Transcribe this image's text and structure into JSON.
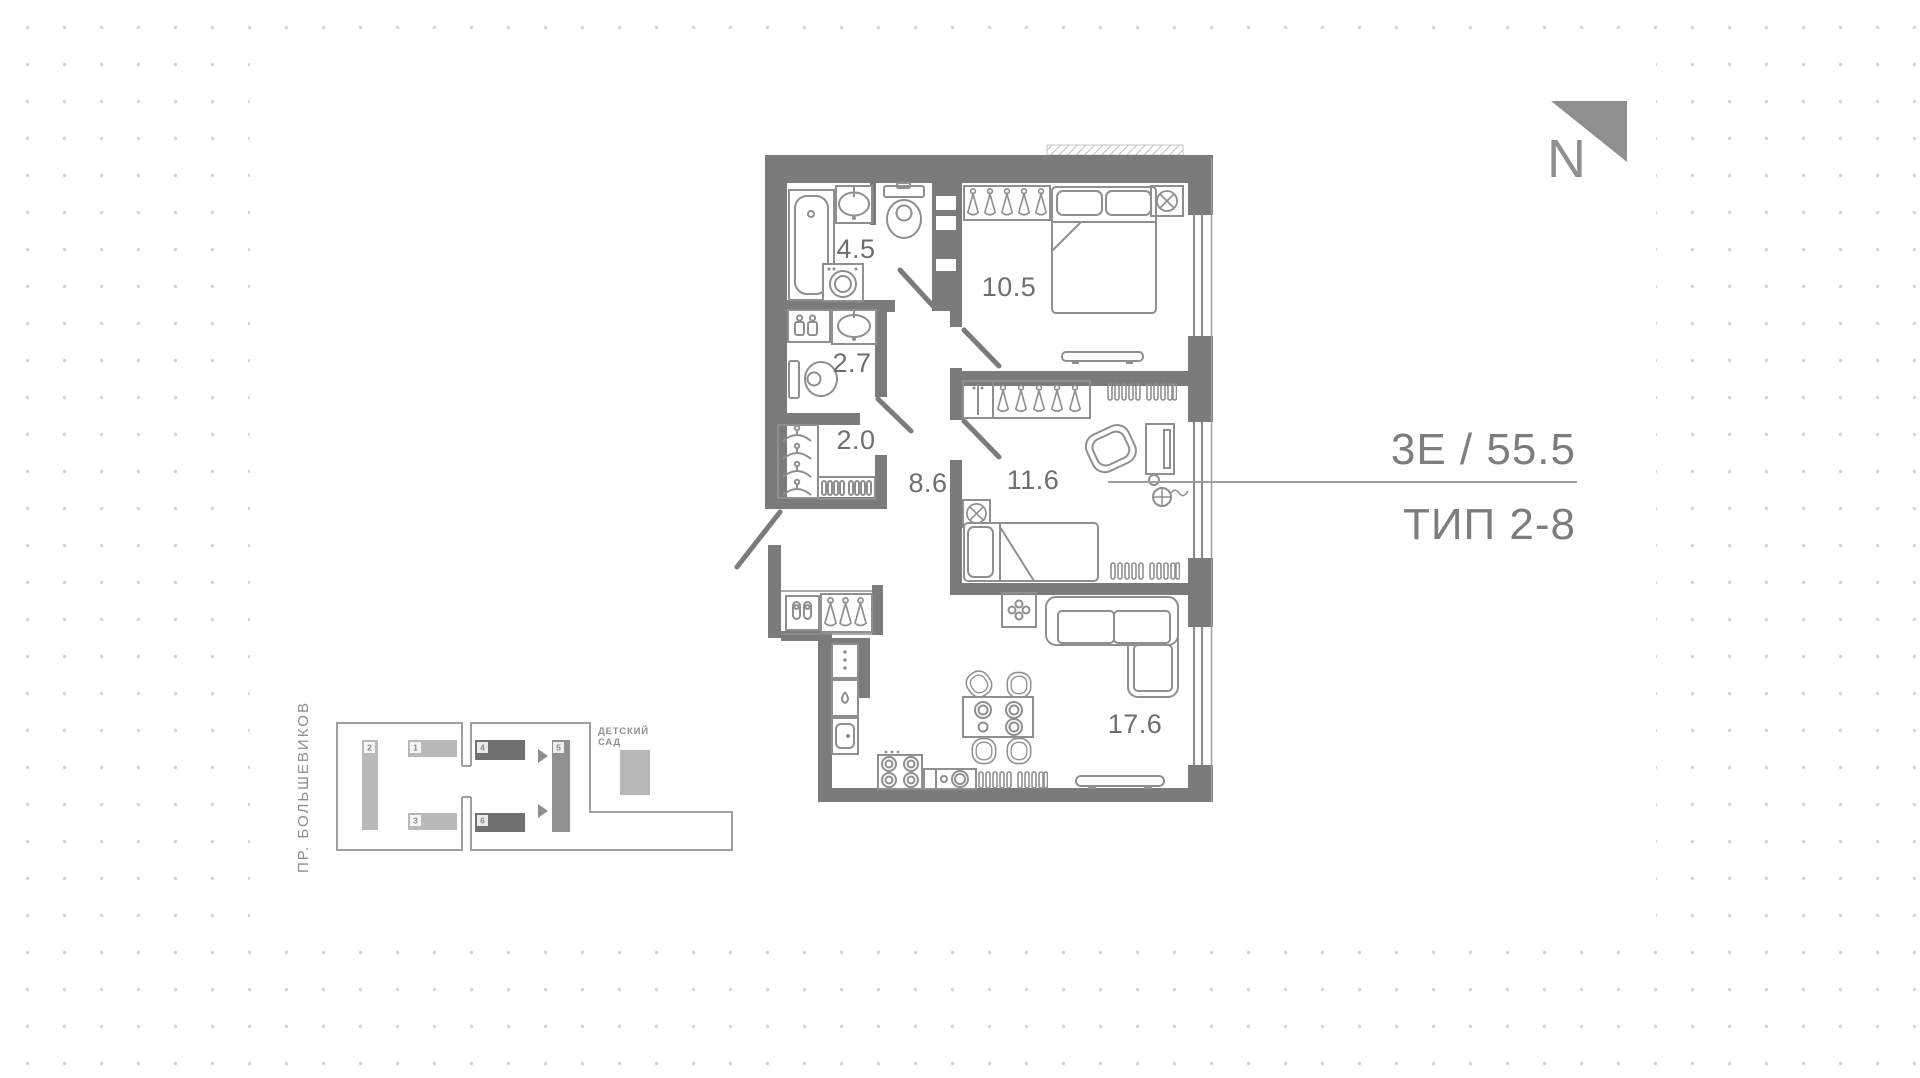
{
  "unit": {
    "title_line1": "3Е / 55.5",
    "title_line2": "ТИП 2-8"
  },
  "north": {
    "label": "N"
  },
  "rooms": {
    "bathroom": "4.5",
    "wc": "2.7",
    "closet": "2.0",
    "hallway": "8.6",
    "bedroom1": "10.5",
    "bedroom2": "11.6",
    "living_kitchen": "17.6"
  },
  "site_plan": {
    "street": "ПР. БОЛЬШЕВИКОВ",
    "kindergarten_line1": "ДЕТСКИЙ",
    "kindergarten_line2": "САД",
    "buildings": {
      "b1": "1",
      "b2": "2",
      "b3": "3",
      "b4": "4",
      "b5": "5",
      "b6": "6"
    }
  },
  "icons": [
    "bathtub-icon",
    "sink-icon",
    "toilet-icon",
    "washing-machine-icon",
    "bottles-icon",
    "hanger-icon",
    "shoe-rack-icon",
    "slippers-icon",
    "double-bed-icon",
    "single-bed-icon",
    "vent-fan-icon",
    "wardrobe-icon",
    "armchair-icon",
    "desk-monitor-icon",
    "convector-icon",
    "sofa-icon",
    "dining-table-icon",
    "chair-icon",
    "plant-icon",
    "fridge-icon",
    "stove-icon",
    "kitchen-sink-icon",
    "radiator-icon",
    "tv-console-icon",
    "north-arrow-icon",
    "route-arrow-icon"
  ],
  "colors": {
    "wall_color": "#7b7b7b",
    "furn_color": "#8f8f8f",
    "label_color": "#6e6e6e",
    "title_color": "#7d7d7d",
    "north_color": "#8f8f8f",
    "dot_color": "#d6d6d6",
    "line_color": "#9e9e9e",
    "bld_light": "#b9b9b9",
    "bld_dark": "#707070",
    "bld_mid": "#909090",
    "kinder_fill": "#b7b7b7",
    "site_line": "#a0a0a0"
  }
}
